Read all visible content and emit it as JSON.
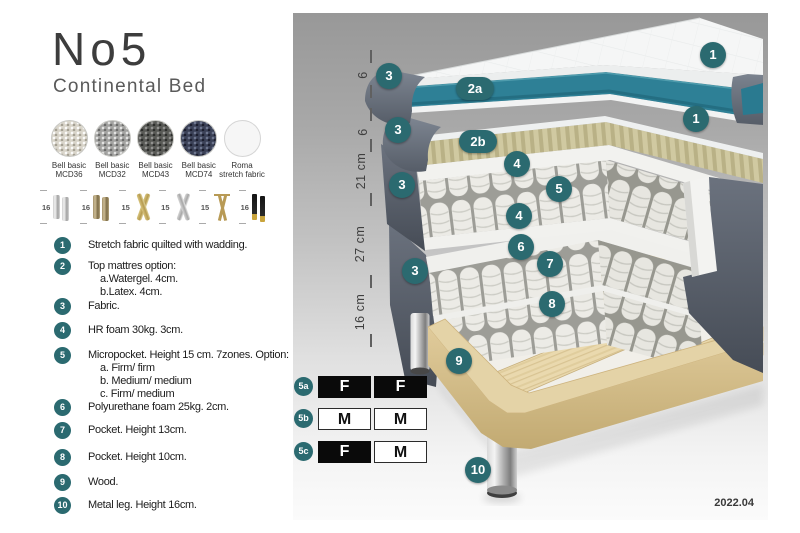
{
  "header": {
    "title": "No5",
    "subtitle": "Continental Bed"
  },
  "swatches": [
    {
      "line1": "Bell basic",
      "line2": "MCD36",
      "color": "#d9d5ca"
    },
    {
      "line1": "Bell basic",
      "line2": "MCD32",
      "color": "#a3a3a1"
    },
    {
      "line1": "Bell basic",
      "line2": "MCD43",
      "color": "#595a56"
    },
    {
      "line1": "Bell basic",
      "line2": "MCD74",
      "color": "#3b4157"
    },
    {
      "line1": "Roma",
      "line2": "stretch fabric",
      "color": "#f6f6f6"
    }
  ],
  "leg_options": [
    {
      "size": "16",
      "style": "cylinder-silver"
    },
    {
      "size": "16",
      "style": "cylinder-bronze"
    },
    {
      "size": "15",
      "style": "cross-gold"
    },
    {
      "size": "15",
      "style": "cross-silver"
    },
    {
      "size": "15",
      "style": "hairpin-gold"
    },
    {
      "size": "16",
      "style": "tapered-black-gold"
    }
  ],
  "features": [
    {
      "num": "1",
      "text": "Stretch fabric quilted with wadding."
    },
    {
      "num": "2",
      "text": "Top mattres option:",
      "sub": [
        "a.Watergel. 4cm.",
        "b.Latex. 4cm."
      ]
    },
    {
      "num": "3",
      "text": "Fabric."
    },
    {
      "num": "4",
      "text": "HR foam 30kg. 3cm."
    },
    {
      "num": "5",
      "text": "Micropocket. Height 15 cm. 7zones. Option:",
      "sub": [
        "a. Firm/ firm",
        "b. Medium/ medium",
        "c. Firm/ medium"
      ]
    },
    {
      "num": "6",
      "text": "Polyurethane foam 25kg. 2cm."
    },
    {
      "num": "7",
      "text": "Pocket. Height 13cm."
    },
    {
      "num": "8",
      "text": "Pocket. Height 10cm."
    },
    {
      "num": "9",
      "text": "Wood."
    },
    {
      "num": "10",
      "text": "Metal leg. Height 16cm."
    }
  ],
  "diagram": {
    "ruler": [
      "6",
      "6",
      "21 cm",
      "27 cm",
      "16 cm"
    ],
    "callouts": {
      "c1a": "1",
      "c1b": "1",
      "c2a": "2a",
      "c2b": "2b",
      "c3a": "3",
      "c3b": "3",
      "c3c": "3",
      "c3d": "3",
      "c4a": "4",
      "c4b": "4",
      "c5": "5",
      "c6": "6",
      "c7": "7",
      "c8": "8",
      "c9": "9",
      "c10": "10"
    },
    "firmness_rows": [
      {
        "id": "5a",
        "cells": [
          {
            "label": "F",
            "tone": "dark"
          },
          {
            "label": "F",
            "tone": "dark"
          }
        ]
      },
      {
        "id": "5b",
        "cells": [
          {
            "label": "M",
            "tone": "light"
          },
          {
            "label": "M",
            "tone": "light"
          }
        ]
      },
      {
        "id": "5c",
        "cells": [
          {
            "label": "F",
            "tone": "dark"
          },
          {
            "label": "M",
            "tone": "light"
          }
        ]
      }
    ],
    "version": "2022.04",
    "accent_color": "#2b6a70",
    "watergel_color": "#2e8096",
    "wood_color": "#e3d2a6",
    "fabric_color": "#636a76"
  }
}
